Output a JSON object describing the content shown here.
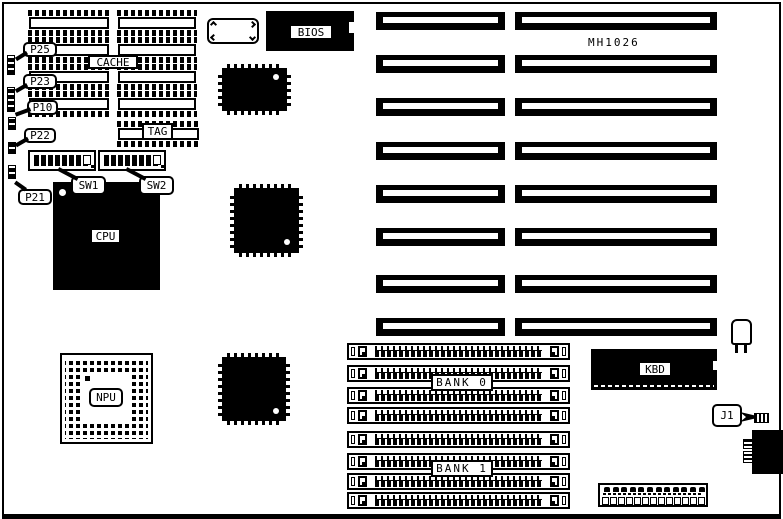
{
  "colors": {
    "ink": "#000000",
    "paper": "#ffffff"
  },
  "labels": {
    "mh1026": "MH1026",
    "bios": "BIOS",
    "cache": "CACHE",
    "tag": "TAG",
    "cpu": "CPU",
    "npu": "NPU",
    "kbd": "KBD",
    "bank0": "BANK 0",
    "bank1": "BANK 1",
    "j1": "J1",
    "p25": "P25",
    "p23": "P23",
    "p10": "P10",
    "p22": "P22",
    "p21": "P21",
    "sw1": "SW1",
    "sw2": "SW2"
  }
}
